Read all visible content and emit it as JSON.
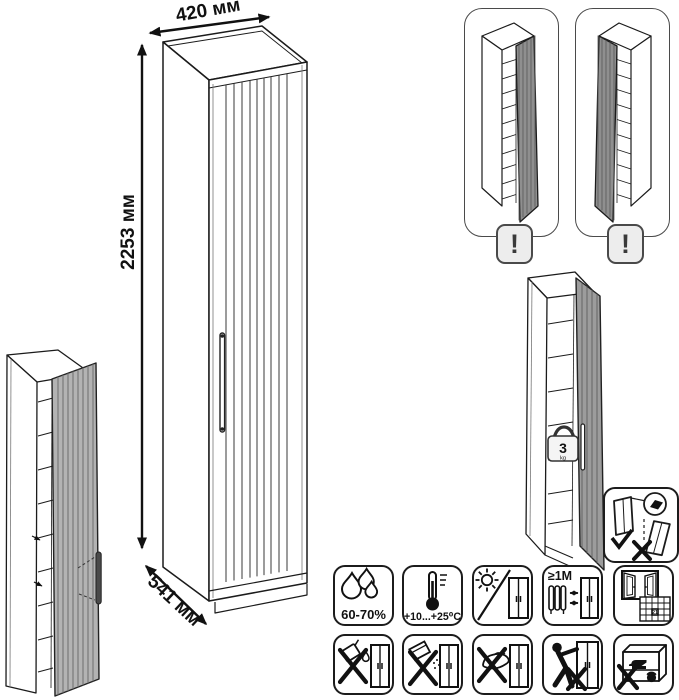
{
  "sheet": {
    "dimensions": {
      "width_label": "420 мм",
      "height_label": "2253 мм",
      "depth_label": "541 мм"
    },
    "hinge_options": {
      "left_panel_warning": "!",
      "right_panel_warning": "!"
    },
    "shelf_load": {
      "value": "3",
      "unit": "kg"
    },
    "care": {
      "humidity_label": "60-70%",
      "temperature_label": "+10...+25⁰C",
      "distance_label": "≥1M",
      "ventilation_calendar_day": "21"
    },
    "colors": {
      "line": "#1b1b1b",
      "door_shade": "#9c9c9c",
      "badge_fill": "#ededed"
    }
  }
}
